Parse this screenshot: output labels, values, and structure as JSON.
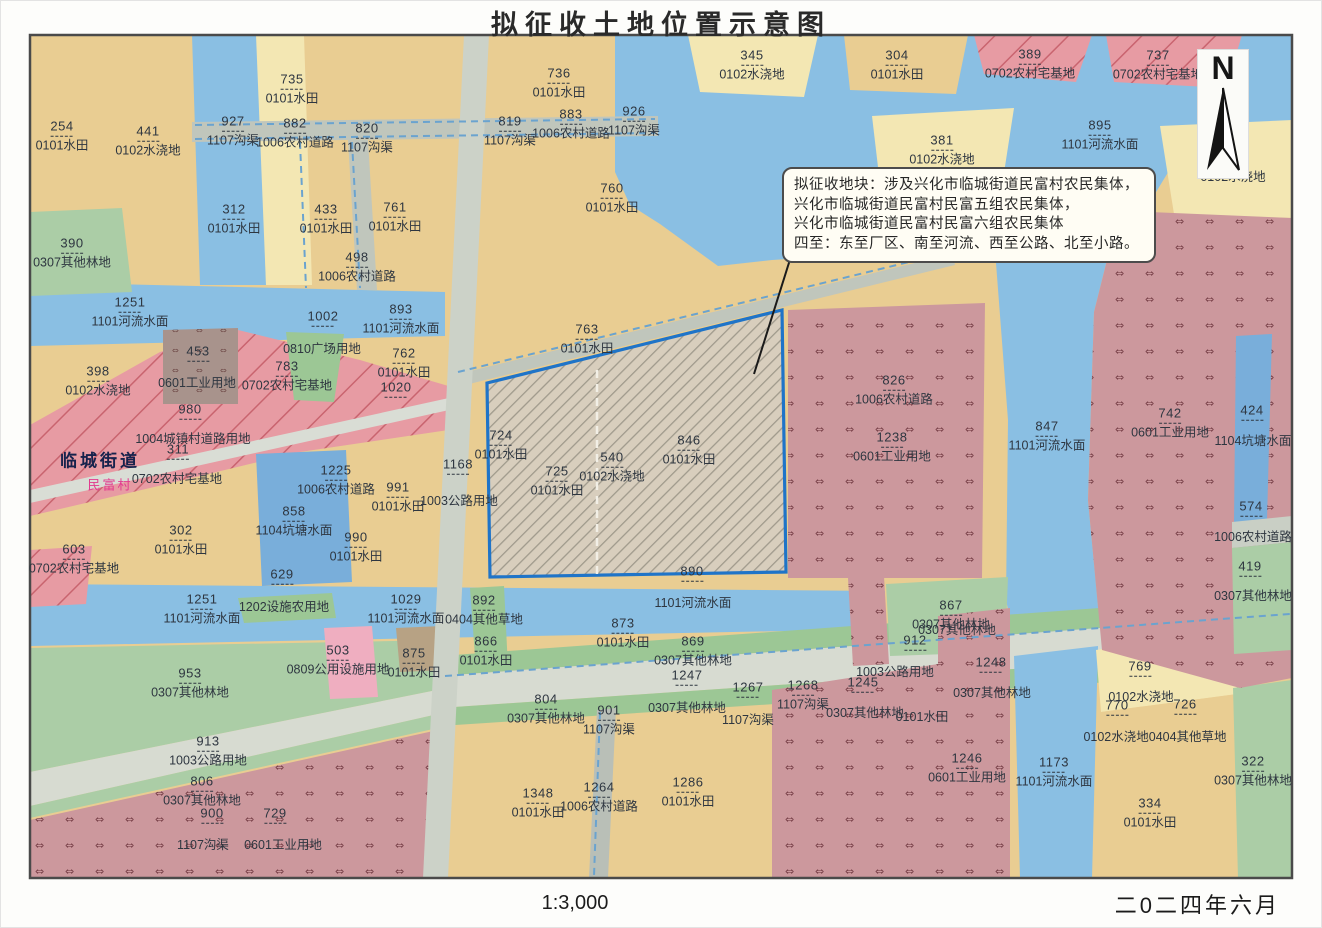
{
  "title": "拟征收土地位置示意图",
  "scale_label": "1:3,000",
  "date_label": "二0二四年六月",
  "north_label": "N",
  "callout": {
    "lines": [
      "拟征收地块：涉及兴化市临城街道民富村农民集体，",
      "兴化市临城街道民富村民富五组农民集体，",
      "兴化市临城街道民富村民富六组农民集体",
      "四至：东至厂区、南至河流、西至公路、北至小路。"
    ]
  },
  "palette": {
    "farmland": "#e9cd92",
    "irrigated": "#f3e7b3",
    "water": "#8abfe3",
    "pond": "#79aeda",
    "forest": "#abcda6",
    "road": "#c0c6bc",
    "residential": "#e79ba3",
    "industrial": "#cc989d",
    "parcel_border": "#1f74c8"
  },
  "map": {
    "labels": [
      {
        "x": 62,
        "y": 136,
        "n": "254",
        "t": "0101水田"
      },
      {
        "x": 148,
        "y": 141,
        "n": "441",
        "t": "0102水浇地"
      },
      {
        "x": 292,
        "y": 89,
        "n": "735",
        "t": "0101水田"
      },
      {
        "x": 233,
        "y": 131,
        "n": "927",
        "t": "1107沟渠"
      },
      {
        "x": 295,
        "y": 133,
        "n": "882",
        "t": "1006农村道路"
      },
      {
        "x": 367,
        "y": 138,
        "n": "820",
        "t": "1107沟渠"
      },
      {
        "x": 559,
        "y": 83,
        "n": "736",
        "t": "0101水田"
      },
      {
        "x": 510,
        "y": 131,
        "n": "819",
        "t": "1107沟渠"
      },
      {
        "x": 571,
        "y": 124,
        "n": "883",
        "t": "1006农村道路"
      },
      {
        "x": 634,
        "y": 121,
        "n": "926",
        "t": "1107沟渠"
      },
      {
        "x": 752,
        "y": 65,
        "n": "345",
        "t": "0102水浇地"
      },
      {
        "x": 897,
        "y": 65,
        "n": "304",
        "t": "0101水田"
      },
      {
        "x": 1030,
        "y": 64,
        "n": "389",
        "t": "0702农村宅基地"
      },
      {
        "x": 1158,
        "y": 65,
        "n": "737",
        "t": "0702农村宅基地"
      },
      {
        "x": 1100,
        "y": 135,
        "n": "895",
        "t": "1101河流水面"
      },
      {
        "x": 942,
        "y": 150,
        "n": "381",
        "t": "0102水浇地"
      },
      {
        "x": 1233,
        "y": 177,
        "t": "0102水浇地"
      },
      {
        "x": 234,
        "y": 219,
        "n": "312",
        "t": "0101水田"
      },
      {
        "x": 326,
        "y": 219,
        "n": "433",
        "t": "0101水田"
      },
      {
        "x": 395,
        "y": 217,
        "n": "761",
        "t": "0101水田"
      },
      {
        "x": 72,
        "y": 253,
        "n": "390",
        "t": "0307其他林地"
      },
      {
        "x": 357,
        "y": 267,
        "n": "498",
        "t": "1006农村道路"
      },
      {
        "x": 612,
        "y": 198,
        "n": "760",
        "t": "0101水田"
      },
      {
        "x": 130,
        "y": 312,
        "n": "1251",
        "t": "1101河流水面"
      },
      {
        "x": 323,
        "y": 319,
        "n": "1002"
      },
      {
        "x": 401,
        "y": 319,
        "n": "893",
        "t": "1101河流水面"
      },
      {
        "x": 404,
        "y": 363,
        "n": "762",
        "t": "0101水田"
      },
      {
        "x": 396,
        "y": 390,
        "n": "1020"
      },
      {
        "x": 98,
        "y": 381,
        "n": "398",
        "t": "0102水浇地"
      },
      {
        "x": 198,
        "y": 354,
        "n": "453"
      },
      {
        "x": 197,
        "y": 383,
        "t": "0601工业用地"
      },
      {
        "x": 287,
        "y": 376,
        "n": "783",
        "t": "0702农村宅基地"
      },
      {
        "x": 322,
        "y": 349,
        "t": "0810广场用地"
      },
      {
        "x": 190,
        "y": 412,
        "n": "980"
      },
      {
        "x": 193,
        "y": 439,
        "t": "1004城镇村道路用地"
      },
      {
        "x": 178,
        "y": 452,
        "n": "311"
      },
      {
        "x": 177,
        "y": 479,
        "t": "0702农村宅基地"
      },
      {
        "x": 100,
        "y": 461,
        "t": "临城街道",
        "c": "lincheng"
      },
      {
        "x": 110,
        "y": 486,
        "t": "民富村",
        "c": "minfu"
      },
      {
        "x": 181,
        "y": 540,
        "n": "302",
        "t": "0101水田"
      },
      {
        "x": 74,
        "y": 559,
        "n": "603",
        "t": "0702农村宅基地"
      },
      {
        "x": 336,
        "y": 480,
        "n": "1225",
        "t": "1006农村道路"
      },
      {
        "x": 294,
        "y": 521,
        "n": "858",
        "t": "1104坑塘水面"
      },
      {
        "x": 398,
        "y": 497,
        "n": "991",
        "t": "0101水田"
      },
      {
        "x": 356,
        "y": 547,
        "n": "990",
        "t": "0101水田"
      },
      {
        "x": 282,
        "y": 577,
        "n": "629"
      },
      {
        "x": 458,
        "y": 467,
        "n": "1168"
      },
      {
        "x": 459,
        "y": 501,
        "t": "1003公路用地"
      },
      {
        "x": 587,
        "y": 339,
        "n": "763",
        "t": "0101水田"
      },
      {
        "x": 501,
        "y": 445,
        "n": "724",
        "t": "0101水田"
      },
      {
        "x": 557,
        "y": 481,
        "n": "725",
        "t": "0101水田"
      },
      {
        "x": 612,
        "y": 467,
        "n": "540",
        "t": "0102水浇地"
      },
      {
        "x": 689,
        "y": 450,
        "n": "846",
        "t": "0101水田"
      },
      {
        "x": 692,
        "y": 574,
        "n": "890"
      },
      {
        "x": 894,
        "y": 390,
        "n": "826",
        "t": "1006农村道路"
      },
      {
        "x": 892,
        "y": 447,
        "n": "1238",
        "t": "0601工业用地"
      },
      {
        "x": 1047,
        "y": 436,
        "n": "847",
        "t": "1101河流水面"
      },
      {
        "x": 1170,
        "y": 423,
        "n": "742",
        "t": "0601工业用地"
      },
      {
        "x": 1252,
        "y": 413,
        "n": "424"
      },
      {
        "x": 1253,
        "y": 441,
        "t": "1104坑塘水面"
      },
      {
        "x": 1251,
        "y": 509,
        "n": "574"
      },
      {
        "x": 1253,
        "y": 537,
        "t": "1006农村道路"
      },
      {
        "x": 1250,
        "y": 569,
        "n": "419"
      },
      {
        "x": 1253,
        "y": 596,
        "t": "0307其他林地"
      },
      {
        "x": 202,
        "y": 609,
        "n": "1251",
        "t": "1101河流水面"
      },
      {
        "x": 284,
        "y": 607,
        "t": "1202设施农用地"
      },
      {
        "x": 406,
        "y": 609,
        "n": "1029",
        "t": "1101河流水面"
      },
      {
        "x": 484,
        "y": 610,
        "n": "892",
        "t": "0404其他草地"
      },
      {
        "x": 486,
        "y": 651,
        "n": "866",
        "t": "0101水田"
      },
      {
        "x": 693,
        "y": 603,
        "t": "1101河流水面"
      },
      {
        "x": 623,
        "y": 633,
        "n": "873",
        "t": "0101水田"
      },
      {
        "x": 693,
        "y": 651,
        "n": "869",
        "t": "0307其他林地"
      },
      {
        "x": 687,
        "y": 678,
        "n": "1247"
      },
      {
        "x": 748,
        "y": 690,
        "n": "1267"
      },
      {
        "x": 546,
        "y": 709,
        "n": "804",
        "t": "0307其他林地"
      },
      {
        "x": 609,
        "y": 720,
        "n": "901",
        "t": "1107沟渠"
      },
      {
        "x": 687,
        "y": 708,
        "t": "0307其他林地"
      },
      {
        "x": 748,
        "y": 720,
        "t": "1107沟渠"
      },
      {
        "x": 803,
        "y": 695,
        "n": "1268",
        "t": "1107沟渠"
      },
      {
        "x": 863,
        "y": 685,
        "n": "1245"
      },
      {
        "x": 865,
        "y": 713,
        "t": "0307其他林地"
      },
      {
        "x": 951,
        "y": 615,
        "n": "867",
        "t": "0307其他林地"
      },
      {
        "x": 957,
        "y": 630,
        "t": "0307其他林地"
      },
      {
        "x": 915,
        "y": 643,
        "n": "912"
      },
      {
        "x": 895,
        "y": 672,
        "t": "1003公路用地"
      },
      {
        "x": 991,
        "y": 665,
        "n": "1248"
      },
      {
        "x": 992,
        "y": 693,
        "t": "0307其他林地"
      },
      {
        "x": 922,
        "y": 717,
        "t": "0101水田"
      },
      {
        "x": 967,
        "y": 768,
        "n": "1246",
        "t": "0601工业用地"
      },
      {
        "x": 1140,
        "y": 669,
        "n": "769"
      },
      {
        "x": 1141,
        "y": 697,
        "t": "0102水浇地"
      },
      {
        "x": 1117,
        "y": 708,
        "n": "770"
      },
      {
        "x": 1185,
        "y": 707,
        "n": "726"
      },
      {
        "x": 1155,
        "y": 737,
        "t": "0102水浇地0404其他草地"
      },
      {
        "x": 1054,
        "y": 772,
        "n": "1173",
        "t": "1101河流水面"
      },
      {
        "x": 1253,
        "y": 771,
        "n": "322",
        "t": "0307其他林地"
      },
      {
        "x": 1150,
        "y": 813,
        "n": "334",
        "t": "0101水田"
      },
      {
        "x": 338,
        "y": 660,
        "n": "503",
        "t": "0809公用设施用地"
      },
      {
        "x": 414,
        "y": 663,
        "n": "875",
        "t": "0101水田"
      },
      {
        "x": 190,
        "y": 683,
        "n": "953",
        "t": "0307其他林地"
      },
      {
        "x": 208,
        "y": 751,
        "n": "913",
        "t": "1003公路用地"
      },
      {
        "x": 202,
        "y": 791,
        "n": "806",
        "t": "0307其他林地"
      },
      {
        "x": 212,
        "y": 816,
        "n": "900"
      },
      {
        "x": 275,
        "y": 816,
        "n": "729"
      },
      {
        "x": 203,
        "y": 845,
        "t": "1107沟渠"
      },
      {
        "x": 283,
        "y": 845,
        "t": "0601工业用地"
      },
      {
        "x": 538,
        "y": 803,
        "n": "1348",
        "t": "0101水田"
      },
      {
        "x": 599,
        "y": 797,
        "n": "1264",
        "t": "1006农村道路"
      },
      {
        "x": 688,
        "y": 792,
        "n": "1286",
        "t": "0101水田"
      }
    ]
  }
}
